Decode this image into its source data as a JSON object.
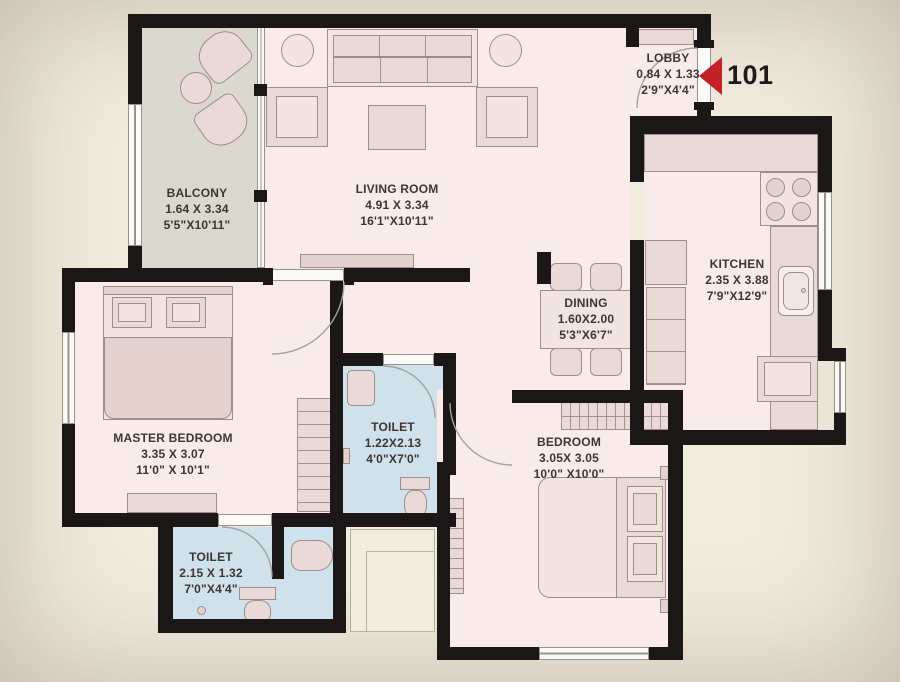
{
  "unit": {
    "number": "101"
  },
  "rooms": [
    {
      "key": "balcony",
      "name": "BALCONY",
      "dim_m": "1.64 X 3.34",
      "dim_ft": "5'5\"X10'11\""
    },
    {
      "key": "living_room",
      "name": "LIVING ROOM",
      "dim_m": "4.91 X 3.34",
      "dim_ft": "16'1\"X10'11\""
    },
    {
      "key": "lobby",
      "name": "LOBBY",
      "dim_m": "0.84 X 1.33",
      "dim_ft": "2'9\"X4'4\""
    },
    {
      "key": "kitchen",
      "name": "KITCHEN",
      "dim_m": "2.35 X 3.88",
      "dim_ft": "7'9\"X12'9\""
    },
    {
      "key": "dining",
      "name": "DINING",
      "dim_m": "1.60X2.00",
      "dim_ft": "5'3\"X6'7\""
    },
    {
      "key": "master_bedroom",
      "name": "MASTER BEDROOM",
      "dim_m": "3.35 X 3.07",
      "dim_ft": "11'0\" X 10'1\""
    },
    {
      "key": "toilet_common",
      "name": "TOILET",
      "dim_m": "1.22X2.13",
      "dim_ft": "4'0\"X7'0\""
    },
    {
      "key": "bedroom",
      "name": "BEDROOM",
      "dim_m": "3.05X 3.05",
      "dim_ft": "10'0\" X10'0\""
    },
    {
      "key": "toilet_master",
      "name": "TOILET",
      "dim_m": "2.15 X 1.32",
      "dim_ft": "7'0\"X4'4\""
    }
  ],
  "colors": {
    "wall": "#1b1717",
    "room_floor": "#f8ebe9",
    "balcony_floor": "#dbd8ce",
    "toilet_floor": "#cfe1ea",
    "furniture": "#e9dad7",
    "entrance_arrow": "#c32128",
    "background": "#f2ecdf",
    "text": "#3f3630"
  }
}
